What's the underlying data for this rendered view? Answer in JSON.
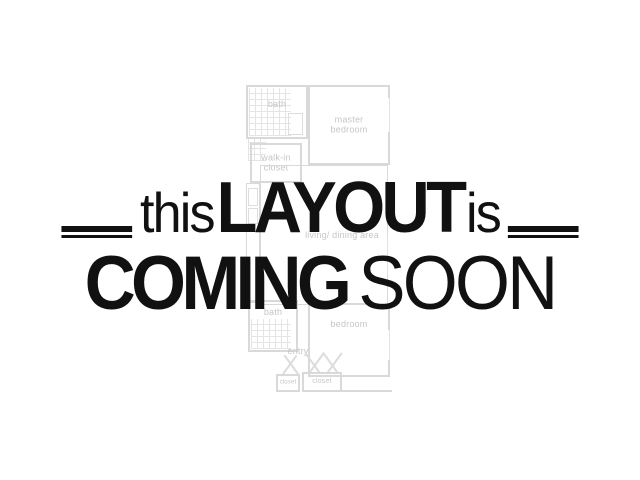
{
  "headline": {
    "word_small_1": "this",
    "word_large_1": "LAYOUT",
    "word_small_2": "is",
    "word_large_2": "COMING",
    "word_light_2": "SOON",
    "text_color": "#111111"
  },
  "floorplan": {
    "line_color": "#d9d9d9",
    "label_color": "#c6c6c6",
    "labels": {
      "bath_upper": "bath",
      "master_bedroom": "master bedroom",
      "walkin_closet": "walk-in closet",
      "living_dining": "living/ dining area",
      "bath_lower": "bath",
      "bedroom": "bedroom",
      "entry": "entry",
      "closet_small": "closet",
      "closet_main": "closet"
    }
  }
}
